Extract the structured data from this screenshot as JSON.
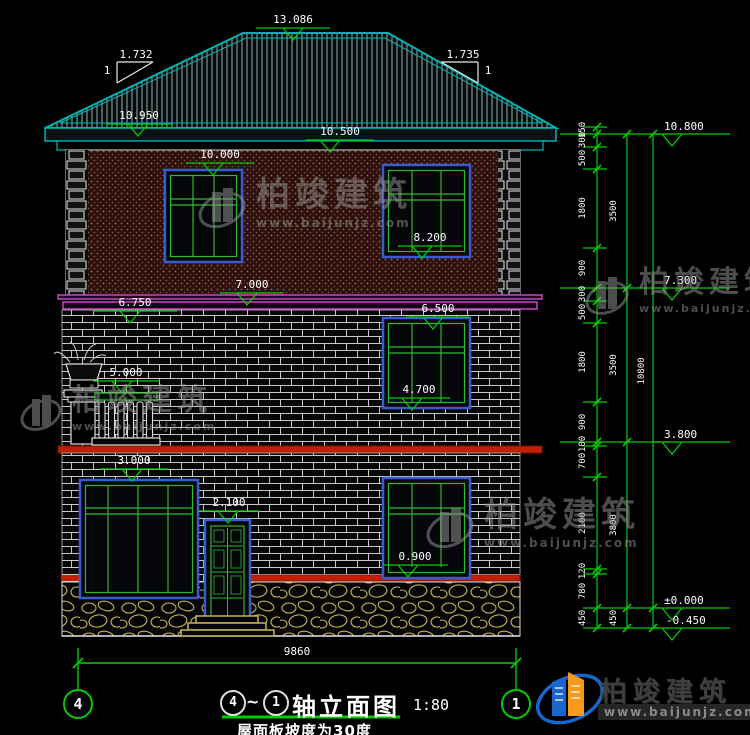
{
  "title": {
    "ax_l": "4",
    "tilde": "~",
    "ax_r": "1",
    "text": "轴立面图",
    "scale": "1:80",
    "note": "屋面板坡度为30度"
  },
  "axes": {
    "left": "4",
    "right": "1"
  },
  "markers": {
    "ridge": "13.086",
    "eave_left": "10.950",
    "eave_mid": "10.500",
    "f3_win_top": "10.000",
    "f3_win_sill": "8.200",
    "f3_band_top": "7.000",
    "f3_band_bot": "6.750",
    "f2_win_top": "6.500",
    "balcony": "5.000",
    "f2_win_sill": "4.700",
    "f1_win_top": "3.000",
    "door_top": "2.100",
    "f1_win_sill": "0.900",
    "r_eave": "10.800",
    "r_f3": "7.300",
    "r_f2": "3.800",
    "r_zero": "±0.000",
    "r_base": "-0.450"
  },
  "slope": {
    "l_run": "1.732",
    "l_rise": "1",
    "r_run": "1.735",
    "r_rise": "1"
  },
  "dims": {
    "width": "9860",
    "overall": "10800",
    "chain": [
      "150",
      "300",
      "500",
      "1800",
      "900",
      "300",
      "500",
      "1800",
      "900",
      "100",
      "700",
      "2100",
      "120",
      "780",
      "450"
    ],
    "floors": [
      "3500",
      "3500",
      "3800",
      "450"
    ]
  },
  "brand": {
    "name": "柏竣建筑",
    "url": "www.baijunjz.com"
  },
  "colors": {
    "dim_green": "#00cc00",
    "roof_cyan": "#00b3b3",
    "band_purple": "#c04ac0",
    "band_red": "#c21f00",
    "frame_blue": "#3a5bd0",
    "sash_green": "#2eb82e",
    "stone_yellow": "#c9b45a"
  }
}
